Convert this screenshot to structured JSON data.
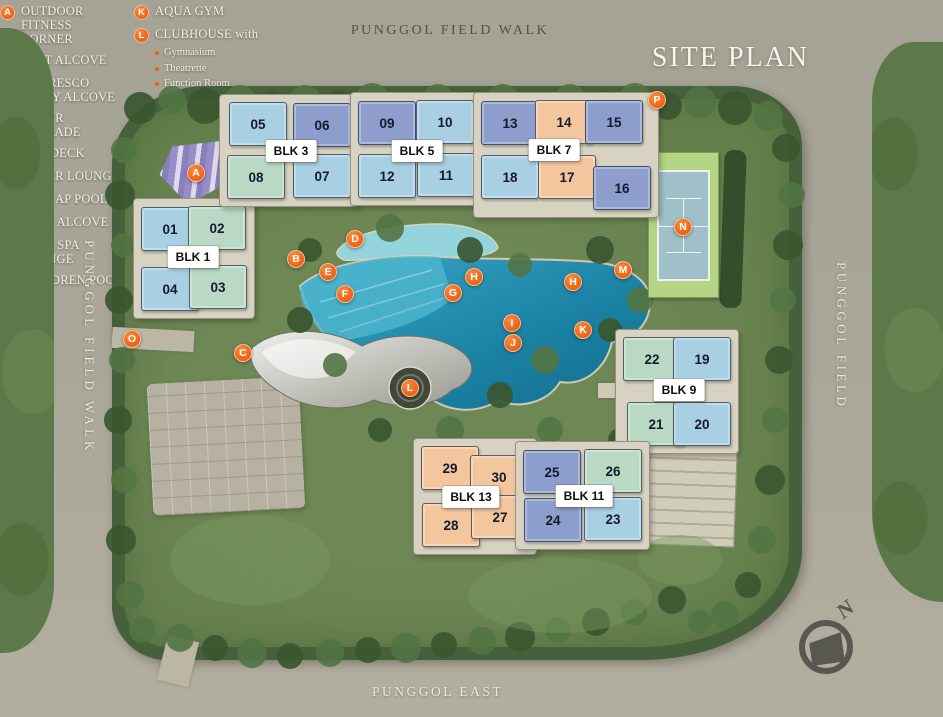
{
  "title": "SITE PLAN",
  "streets": {
    "top": "PUNGGOL FIELD WALK",
    "left": "PUNGGOL FIELD WALK",
    "right": "PUNGGOL FIELD",
    "bottom": "PUNGGOL EAST"
  },
  "compass": {
    "label": "N"
  },
  "palette": {
    "light_blue": "#a9cfe3",
    "medium_blue": "#8d9ecd",
    "pale_green": "#b9d9c5",
    "peach": "#f4c69e",
    "marker_orange": "#ee6012"
  },
  "clusters": [
    {
      "label": "BLK 1",
      "lx": 193,
      "ly": 257,
      "units": [
        {
          "no": "01",
          "x": 170,
          "y": 229,
          "c": "light_blue"
        },
        {
          "no": "02",
          "x": 217,
          "y": 228,
          "c": "pale_green"
        },
        {
          "no": "04",
          "x": 170,
          "y": 289,
          "c": "light_blue"
        },
        {
          "no": "03",
          "x": 218,
          "y": 287,
          "c": "pale_green"
        }
      ]
    },
    {
      "label": "BLK 3",
      "lx": 291,
      "ly": 151,
      "units": [
        {
          "no": "05",
          "x": 258,
          "y": 124,
          "c": "light_blue"
        },
        {
          "no": "06",
          "x": 322,
          "y": 125,
          "c": "medium_blue"
        },
        {
          "no": "08",
          "x": 256,
          "y": 177,
          "c": "pale_green"
        },
        {
          "no": "07",
          "x": 322,
          "y": 176,
          "c": "light_blue"
        }
      ]
    },
    {
      "label": "BLK 5",
      "lx": 417,
      "ly": 151,
      "units": [
        {
          "no": "09",
          "x": 387,
          "y": 123,
          "c": "medium_blue"
        },
        {
          "no": "10",
          "x": 445,
          "y": 122,
          "c": "light_blue"
        },
        {
          "no": "12",
          "x": 387,
          "y": 176,
          "c": "light_blue"
        },
        {
          "no": "11",
          "x": 446,
          "y": 175,
          "c": "light_blue"
        }
      ]
    },
    {
      "label": "BLK 7",
      "lx": 554,
      "ly": 150,
      "units": [
        {
          "no": "13",
          "x": 510,
          "y": 123,
          "c": "medium_blue"
        },
        {
          "no": "14",
          "x": 564,
          "y": 122,
          "c": "peach"
        },
        {
          "no": "15",
          "x": 614,
          "y": 122,
          "c": "medium_blue"
        },
        {
          "no": "18",
          "x": 510,
          "y": 177,
          "c": "light_blue"
        },
        {
          "no": "17",
          "x": 567,
          "y": 177,
          "c": "peach"
        },
        {
          "no": "16",
          "x": 622,
          "y": 188,
          "c": "medium_blue"
        }
      ]
    },
    {
      "label": "BLK 9",
      "lx": 679,
      "ly": 390,
      "units": [
        {
          "no": "22",
          "x": 652,
          "y": 359,
          "c": "pale_green"
        },
        {
          "no": "19",
          "x": 702,
          "y": 359,
          "c": "light_blue"
        },
        {
          "no": "21",
          "x": 656,
          "y": 424,
          "c": "pale_green"
        },
        {
          "no": "20",
          "x": 702,
          "y": 424,
          "c": "light_blue"
        }
      ]
    },
    {
      "label": "BLK 13",
      "lx": 471,
      "ly": 497,
      "units": [
        {
          "no": "29",
          "x": 450,
          "y": 468,
          "c": "peach"
        },
        {
          "no": "30",
          "x": 499,
          "y": 477,
          "c": "peach"
        },
        {
          "no": "28",
          "x": 451,
          "y": 525,
          "c": "peach"
        },
        {
          "no": "27",
          "x": 500,
          "y": 517,
          "c": "peach"
        }
      ]
    },
    {
      "label": "BLK 11",
      "lx": 584,
      "ly": 496,
      "units": [
        {
          "no": "25",
          "x": 552,
          "y": 472,
          "c": "medium_blue"
        },
        {
          "no": "26",
          "x": 613,
          "y": 471,
          "c": "pale_green"
        },
        {
          "no": "24",
          "x": 553,
          "y": 520,
          "c": "medium_blue"
        },
        {
          "no": "23",
          "x": 613,
          "y": 519,
          "c": "light_blue"
        }
      ]
    }
  ],
  "markers": [
    {
      "letter": "A",
      "x": 196,
      "y": 173
    },
    {
      "letter": "B",
      "x": 296,
      "y": 259
    },
    {
      "letter": "C",
      "x": 243,
      "y": 353
    },
    {
      "letter": "D",
      "x": 355,
      "y": 239
    },
    {
      "letter": "E",
      "x": 328,
      "y": 272
    },
    {
      "letter": "F",
      "x": 345,
      "y": 294
    },
    {
      "letter": "G",
      "x": 453,
      "y": 293
    },
    {
      "letter": "H",
      "x": 474,
      "y": 277
    },
    {
      "letter": "H",
      "x": 573,
      "y": 282
    },
    {
      "letter": "I",
      "x": 512,
      "y": 323
    },
    {
      "letter": "J",
      "x": 513,
      "y": 343
    },
    {
      "letter": "K",
      "x": 583,
      "y": 330
    },
    {
      "letter": "L",
      "x": 410,
      "y": 388
    },
    {
      "letter": "M",
      "x": 623,
      "y": 270
    },
    {
      "letter": "N",
      "x": 683,
      "y": 227
    },
    {
      "letter": "O",
      "x": 132,
      "y": 339
    },
    {
      "letter": "P",
      "x": 657,
      "y": 100
    }
  ],
  "legend": {
    "columns": [
      {
        "items": [
          {
            "letter": "A",
            "text": "OUTDOOR FITNESS CORNER"
          },
          {
            "letter": "B",
            "text": "REST ALCOVE"
          },
          {
            "letter": "C",
            "text": "AL FRESCO PARTY ALCOVE"
          },
          {
            "letter": "D",
            "text": "WATER CASCADE"
          },
          {
            "letter": "E",
            "text": "SUN DECK"
          },
          {
            "letter": "F",
            "text": "WATER LOUNGE"
          },
          {
            "letter": "G",
            "text": "50m LAP POOL"
          },
          {
            "letter": "H",
            "text": "POOL ALCOVE"
          },
          {
            "letter": "I",
            "text": "POOL SPA LOUNGE"
          },
          {
            "letter": "J",
            "text": "CHILDREN POOL"
          }
        ]
      },
      {
        "items": [
          {
            "letter": "K",
            "text": "AQUA GYM"
          },
          {
            "letter": "L",
            "text": "CLUBHOUSE with",
            "subitems": [
              "Gymnasium",
              "Theatrette",
              "Function Room",
              "Male & Female Changing Room & Sauna Room"
            ]
          },
          {
            "letter": "M",
            "text": "CHILDREN PLAYHOUSE"
          },
          {
            "letter": "N",
            "text": "TENNIS COURT"
          },
          {
            "letter": "O",
            "text": "MAIN GATE"
          },
          {
            "letter": "P",
            "text": "SIDE GATE"
          }
        ]
      }
    ]
  }
}
